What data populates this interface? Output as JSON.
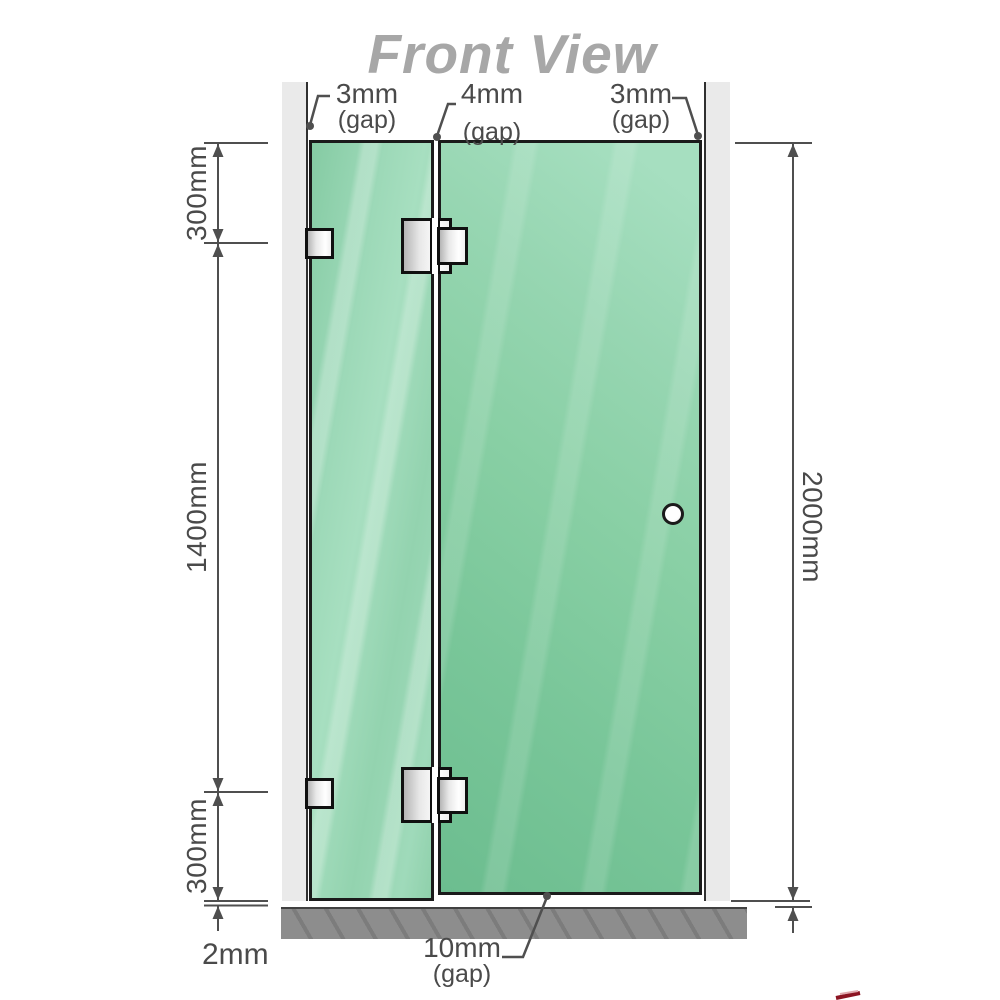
{
  "title": "Front View",
  "gaps": {
    "left": {
      "value": "3mm",
      "caption": "(gap)"
    },
    "middle": {
      "value": "4mm",
      "caption": "(gap)"
    },
    "right": {
      "value": "3mm",
      "caption": "(gap)"
    },
    "bottom": {
      "value": "10mm",
      "caption": "(gap)"
    }
  },
  "dims": {
    "top_segment": "300mm",
    "middle_segment": "1400mm",
    "bottom_segment": "300mm",
    "floor_gap": "2mm",
    "overall_height": "2000mm"
  },
  "colors": {
    "glass_fixed": "#8fd0ab",
    "glass_door": "#7cc69a",
    "wall": "#eaeaea",
    "floor": "#8d8d8d",
    "dimension_line": "#4f4f4f",
    "title_text": "#a7a7a7",
    "hardware_outline": "#101010",
    "accent_red": "#8c1422"
  }
}
